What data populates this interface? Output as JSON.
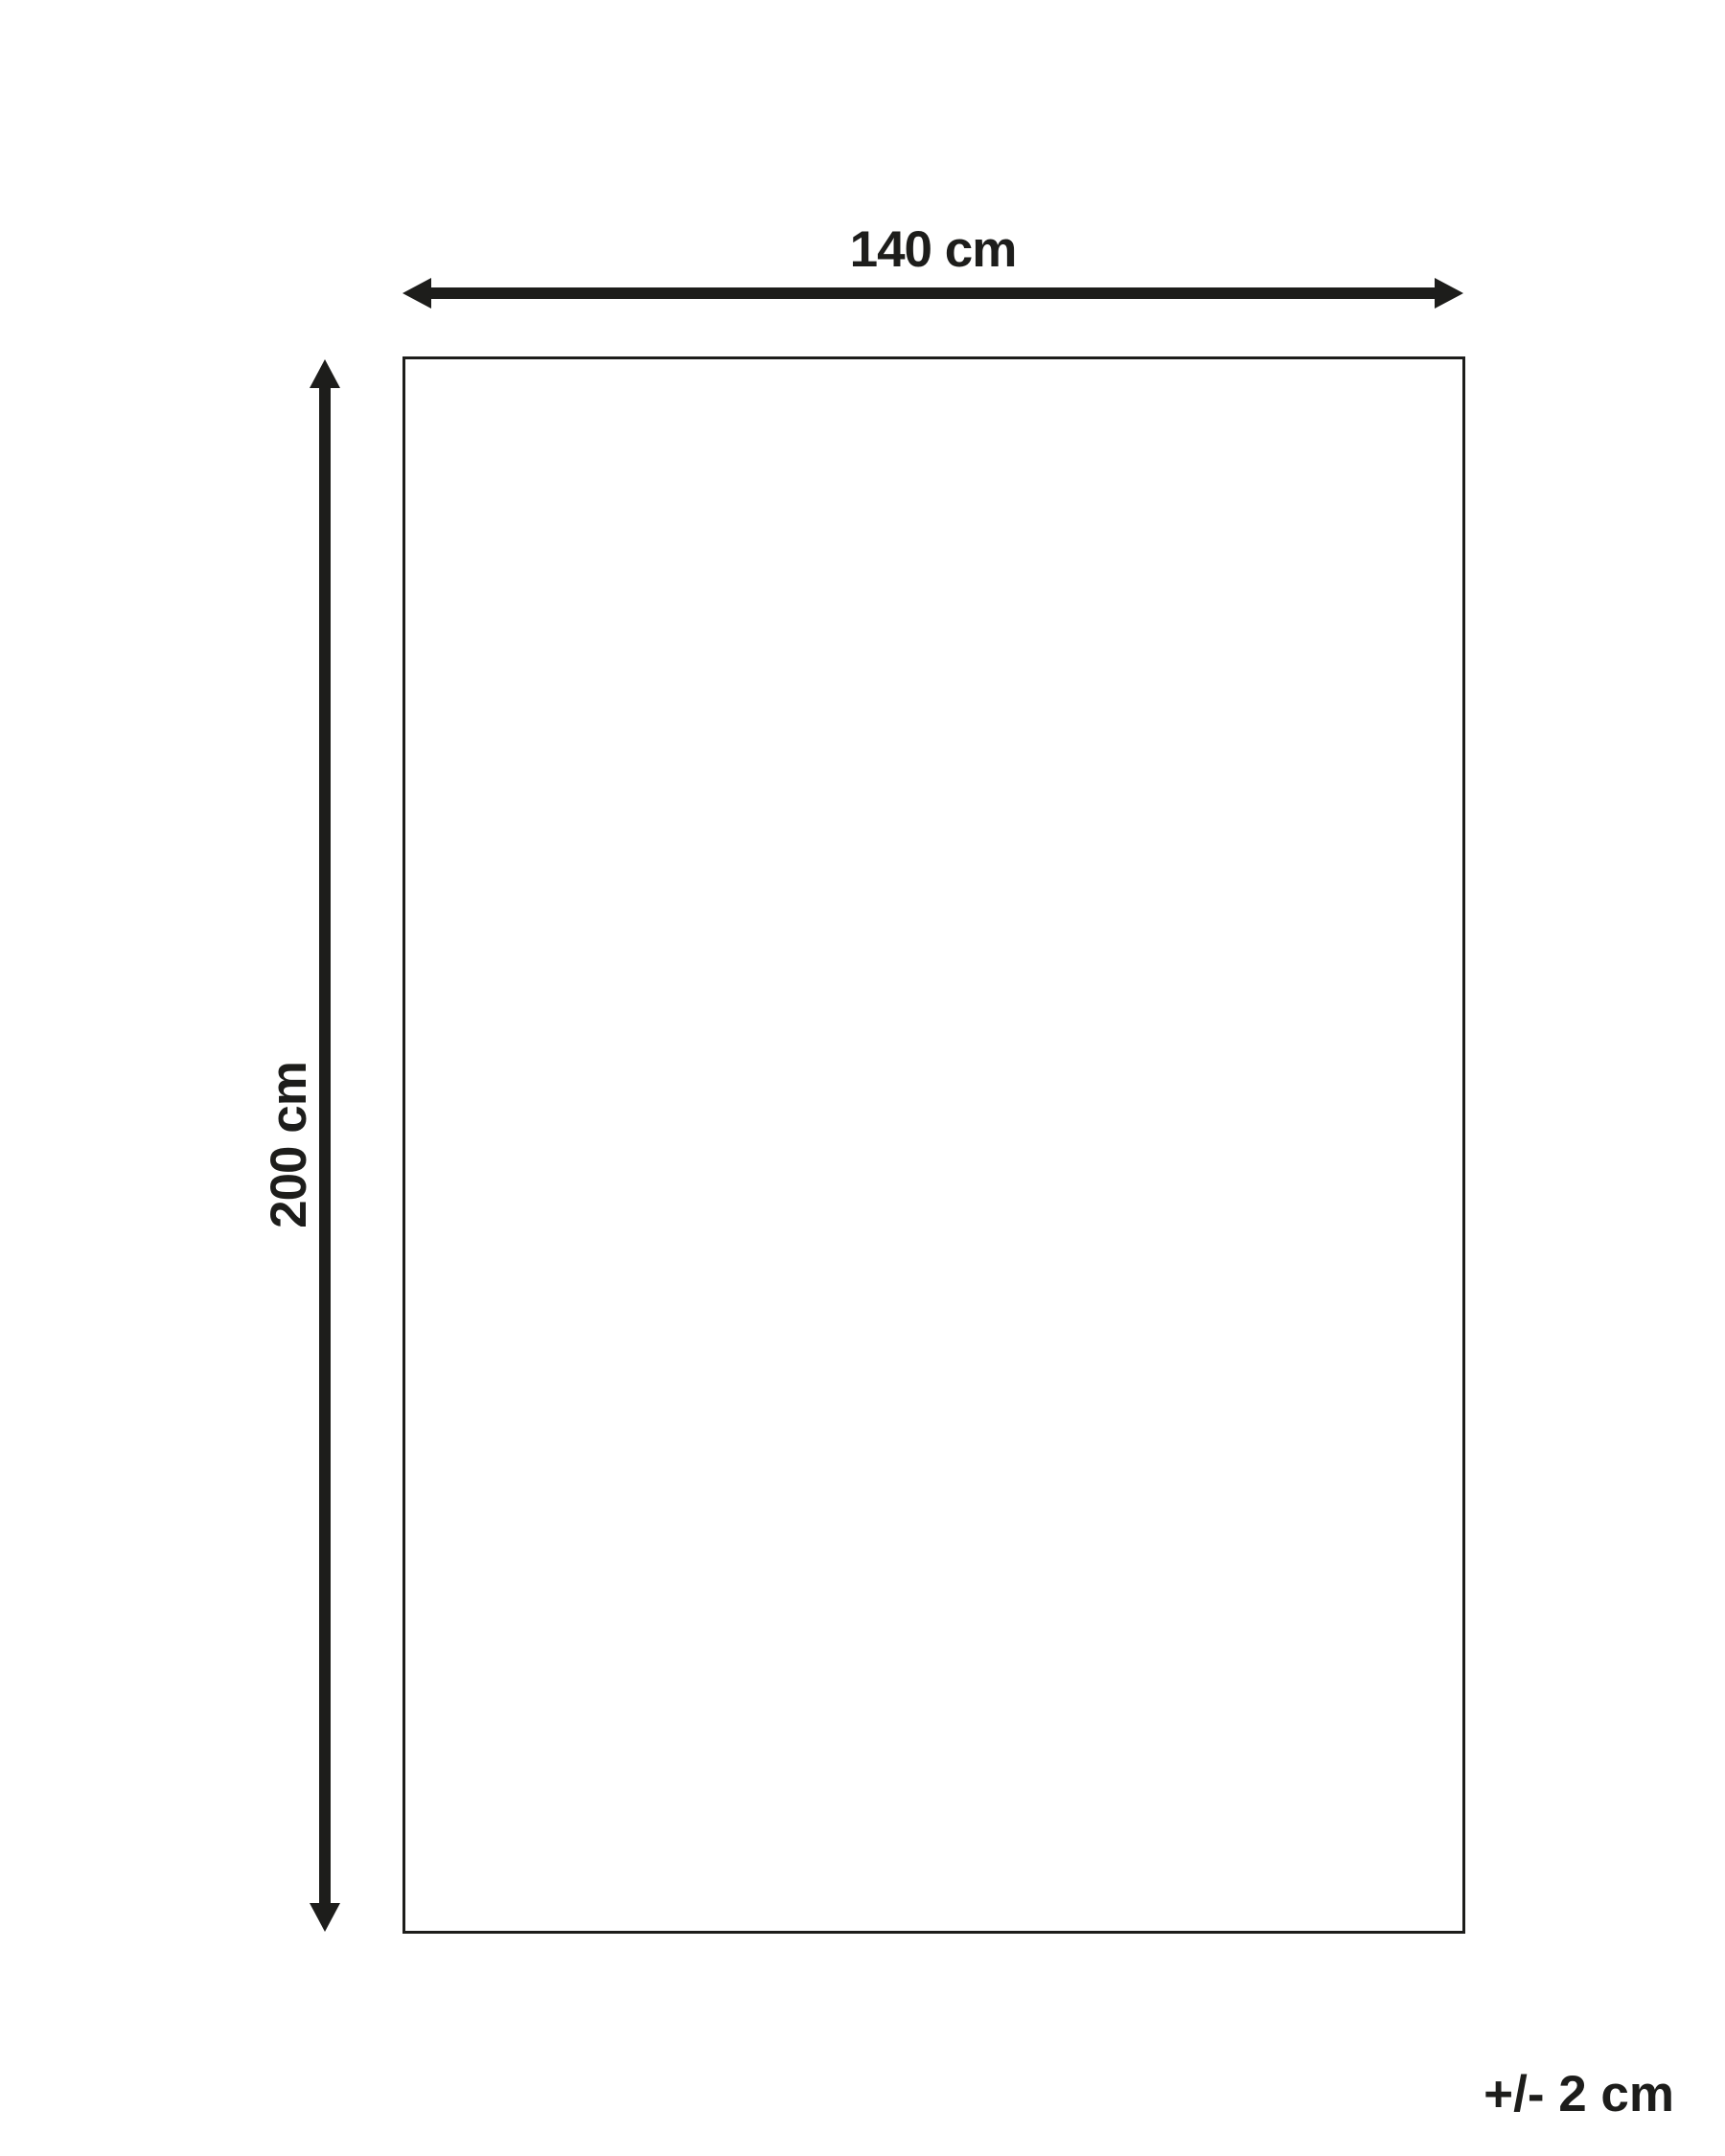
{
  "diagram": {
    "type": "product-dimension-diagram",
    "width_label": "140 cm",
    "height_label": "200 cm",
    "tolerance_label": "+/- 2 cm"
  },
  "colors": {
    "ink": "#1d1d1b",
    "background": "#ffffff"
  }
}
